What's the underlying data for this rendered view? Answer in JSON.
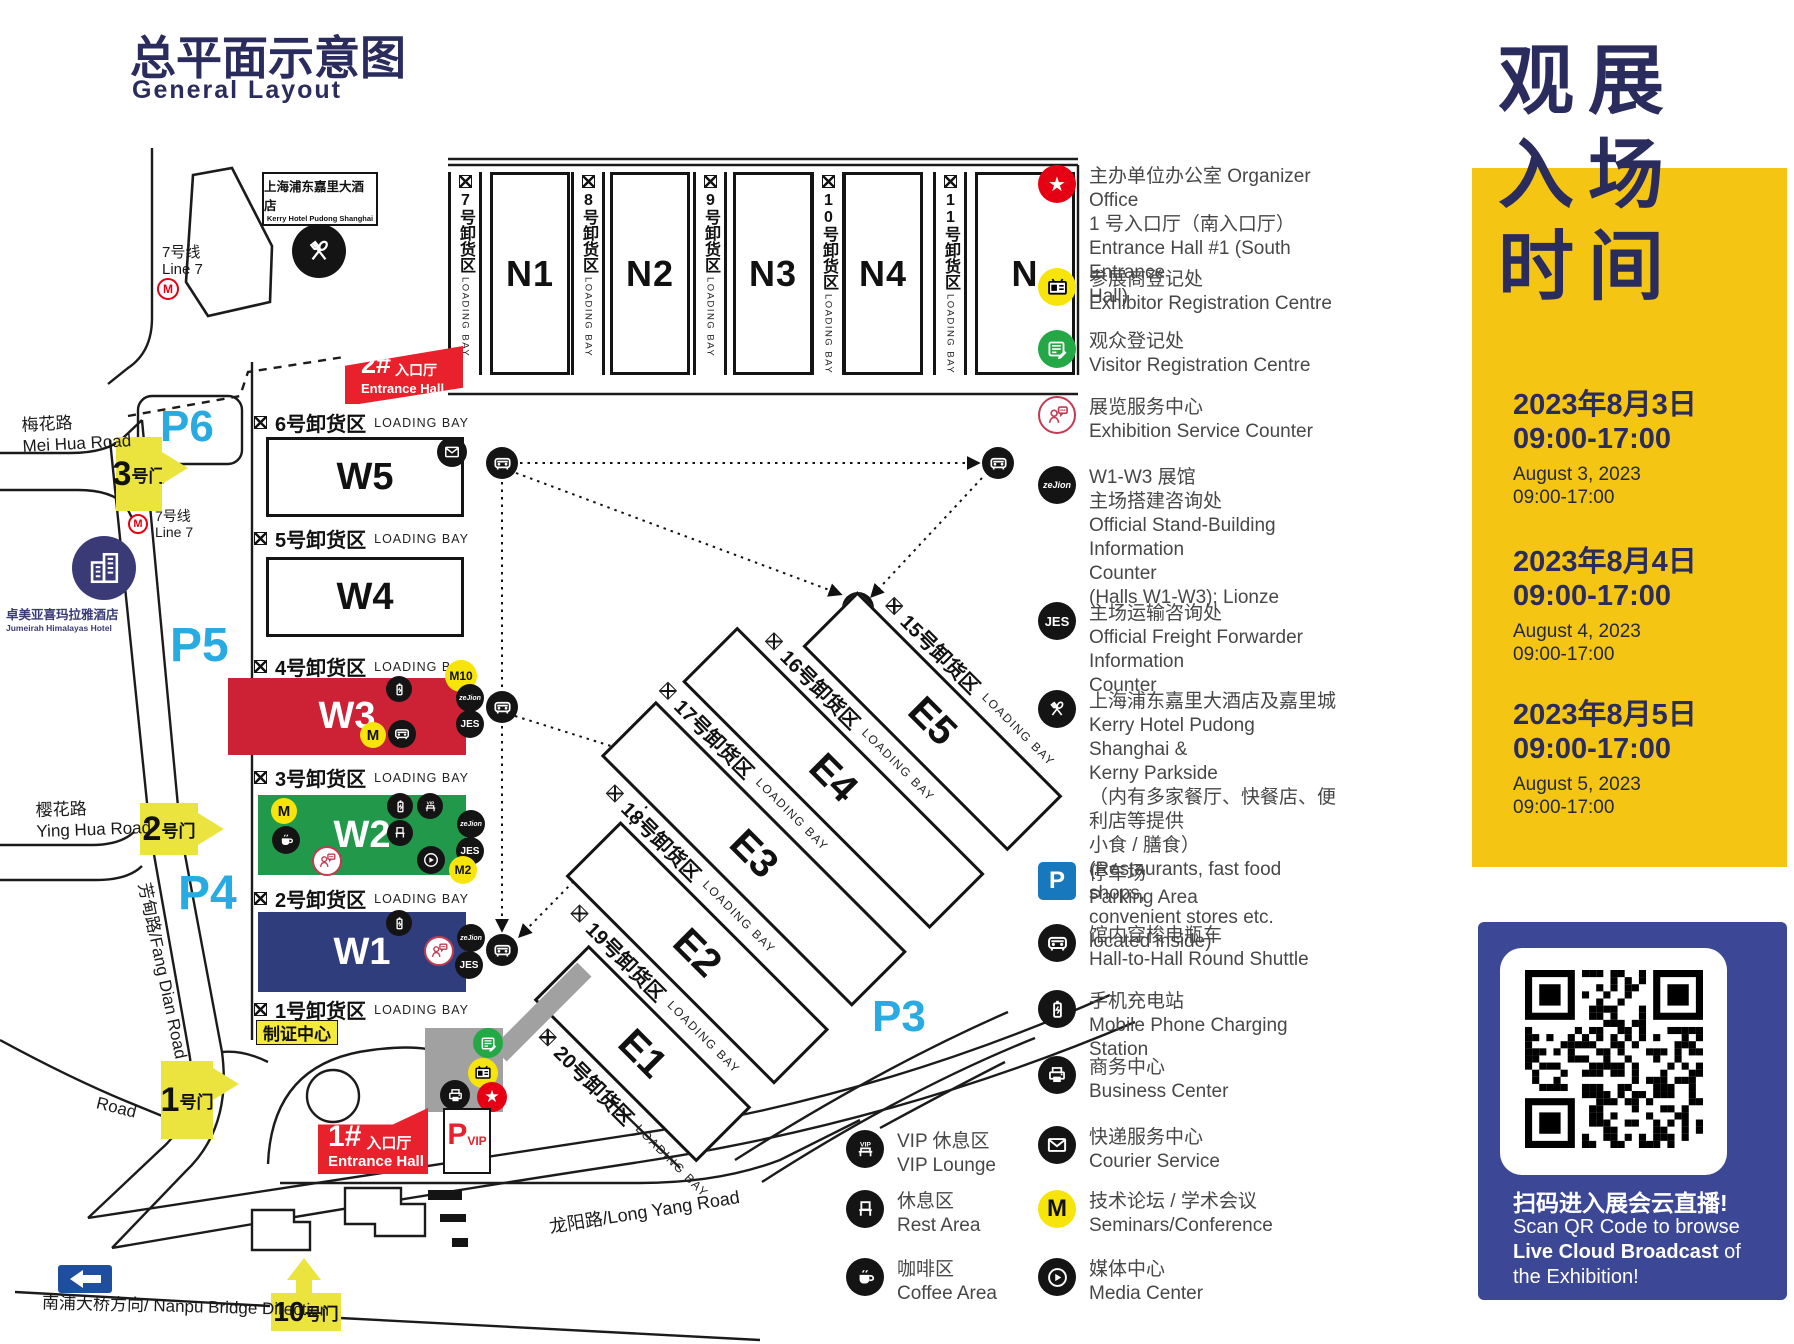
{
  "title": {
    "cn": "总平面示意图",
    "en": "General Layout"
  },
  "map": {
    "n_halls": [
      "N1",
      "N2",
      "N3",
      "N4",
      "N"
    ],
    "n_bays": [
      "7号卸货区",
      "8号卸货区",
      "9号卸货区",
      "10号卸货区",
      "11号卸货区"
    ],
    "w_halls": [
      "W5",
      "W4",
      "W3",
      "W2",
      "W1"
    ],
    "w_bays": [
      "6号卸货区",
      "5号卸货区",
      "4号卸货区",
      "3号卸货区",
      "2号卸货区",
      "1号卸货区"
    ],
    "e_halls": [
      "E5",
      "E4",
      "E3",
      "E2",
      "E1"
    ],
    "e_bays": [
      "15号卸货区",
      "16号卸货区",
      "17号卸货区",
      "18号卸货区",
      "19号卸货区",
      "20号卸货区"
    ],
    "loading_bay": "LOADING BAY",
    "entrance2": {
      "num": "2#",
      "cn": "入口厅",
      "en": "Entrance Hall"
    },
    "entrance1": {
      "num": "1#",
      "cn": "入口厅",
      "en": "Entrance Hall"
    },
    "cert_center": "制证中心",
    "pvip": {
      "p": "P",
      "vip": "VIP"
    },
    "parking_labels": [
      "P6",
      "P5",
      "P4",
      "P3"
    ],
    "gates": {
      "g3": {
        "num": "3",
        "suf": "号门"
      },
      "g2": {
        "num": "2",
        "suf": "号门"
      },
      "g1": {
        "num": "1",
        "suf": "号门"
      },
      "g10": {
        "num": "10",
        "suf": "号门"
      }
    },
    "roads": {
      "meihua": "梅花路\nMei Hua Road",
      "yinghua": "樱花路\nYing Hua Road",
      "fangdian": "芳甸路/Fang Dian Road",
      "road": "Road",
      "longyang": "龙阳路/Long Yang Road",
      "nanpu": "南浦大桥方向/ Nanpu Bridge Direction"
    },
    "kerry": {
      "cn": "上海浦东嘉里大酒店",
      "en": "Kerry Hotel Pudong Shanghai"
    },
    "jumeirah": {
      "cn": "卓美亚喜玛拉雅酒店",
      "en": "Jumeirah Himalayas Hotel"
    },
    "line7": {
      "cn": "7号线",
      "en": "Line 7",
      "m": "M"
    },
    "badges": {
      "m": "M",
      "m2": "M2",
      "m10": "M10",
      "jes": "JES",
      "zejion": "zeJion"
    }
  },
  "legend": {
    "items": [
      {
        "text": "主办单位办公室 Organizer Office\n1 号入口厅（南入口厅）\nEntrance Hall #1 (South Entrance\nHall)"
      },
      {
        "text": "参展商登记处\nExhibitor Registration Centre"
      },
      {
        "text": "观众登记处\nVisitor Registration Centre"
      },
      {
        "text": "展览服务中心\nExhibition Service Counter"
      },
      {
        "text": "W1-W3 展馆\n主场搭建咨询处\nOfficial Stand-Building Information\nCounter\n(Halls W1-W3): Lionze"
      },
      {
        "text": "主场运输咨询处\nOfficial Freight Forwarder Information\nCounter"
      },
      {
        "text": "上海浦东嘉里大酒店及嘉里城\nKerry Hotel Pudong Shanghai &\nKerny Parkside\n（内有多家餐厅、快餐店、便利店等提供\n小食 / 膳食）\n (Restaurants, fast food shops,\nconvenient stores etc. located inside)"
      },
      {
        "text": "停车场\nParking Area"
      },
      {
        "text": "馆内穿梭电瓶车\nHall-to-Hall Round Shuttle"
      },
      {
        "text": "手机充电站\nMobile Phone Charging Station"
      },
      {
        "text": "商务中心\nBusiness Center"
      },
      {
        "text": "快递服务中心\nCourier Service"
      },
      {
        "text": "技术论坛 / 学术会议\nSeminars/Conference"
      },
      {
        "text": "媒体中心\nMedia Center"
      }
    ],
    "left": [
      {
        "text": "VIP 休息区\nVIP Lounge"
      },
      {
        "text": "休息区\nRest Area"
      },
      {
        "text": "咖啡区\nCoffee Area"
      }
    ]
  },
  "sidebar": {
    "title_lines": [
      "观展",
      "入场",
      "时间"
    ],
    "sessions": [
      {
        "cn_date": "2023年8月3日",
        "cn_time": "09:00-17:00",
        "en_date": "August 3, 2023",
        "en_time": "09:00-17:00"
      },
      {
        "cn_date": "2023年8月4日",
        "cn_time": "09:00-17:00",
        "en_date": "August 4, 2023",
        "en_time": "09:00-17:00"
      },
      {
        "cn_date": "2023年8月5日",
        "cn_time": "09:00-17:00",
        "en_date": "August 5, 2023",
        "en_time": "09:00-17:00"
      }
    ],
    "qr": {
      "cn": "扫码进入展会云直播!",
      "en1": "Scan QR Code to browse",
      "en2_bold": "Live Cloud Broadcast",
      "en2_rest": " of",
      "en3": "the Exhibition!"
    }
  }
}
